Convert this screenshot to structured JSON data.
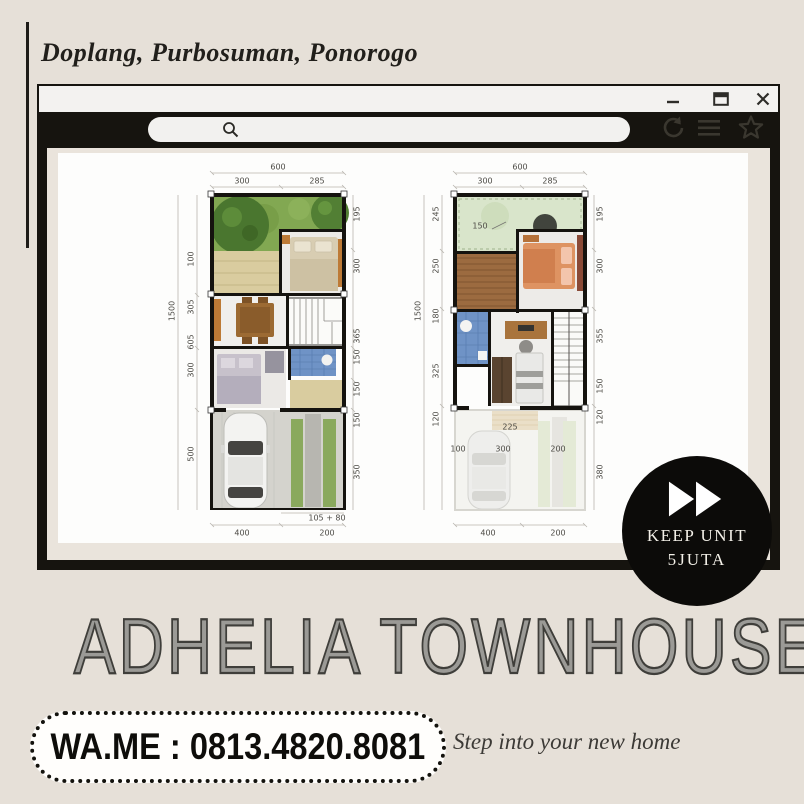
{
  "poster": {
    "location_heading": "Doplang, Purbosuman, Ponorogo",
    "main_title": "ADHELIA TOWNHOUSE",
    "contact": "WA.ME : 0813.4820.8081",
    "tagline": "Step into your new home"
  },
  "badge": {
    "line1": "KEEP UNIT",
    "line2": "5JUTA",
    "icon": "fast-forward-icon"
  },
  "browser": {
    "window_controls": [
      "minimize",
      "maximize",
      "close"
    ],
    "toolbar_icons": [
      "refresh",
      "menu",
      "bookmark-star"
    ],
    "search_icon": "magnifier"
  },
  "colors": {
    "background": "#e6e0d8",
    "frame_black": "#16140f",
    "badge_black": "#0c0b09",
    "grass_green": "#82a852",
    "bathroom_blue": "#6f93c6",
    "deck_brown": "#9c6b40",
    "accent_wood_orange": "#bd7a36",
    "title_gray": "#9b9a96"
  },
  "plans": [
    {
      "name": "ground-floor-plan",
      "dims": {
        "top_total": "600",
        "top": [
          "300",
          "285"
        ],
        "left_total": "1500",
        "left": [
          "100",
          "305",
          "605",
          "300",
          "500"
        ],
        "right": [
          "195",
          "300",
          "365",
          "150",
          "150",
          "150",
          "350"
        ],
        "bottom_small": "105 + 80",
        "bottom": [
          "400",
          "200"
        ]
      }
    },
    {
      "name": "upper-floor-plan",
      "dims": {
        "top_total": "600",
        "top": [
          "300",
          "285"
        ],
        "left_total": "1500",
        "left": [
          "245",
          "250",
          "180",
          "325",
          "120"
        ],
        "right": [
          "195",
          "300",
          "355",
          "150",
          "120",
          "380"
        ],
        "interior": [
          "150",
          "225",
          "100",
          "300",
          "200"
        ],
        "bottom": [
          "400",
          "200"
        ]
      }
    }
  ]
}
